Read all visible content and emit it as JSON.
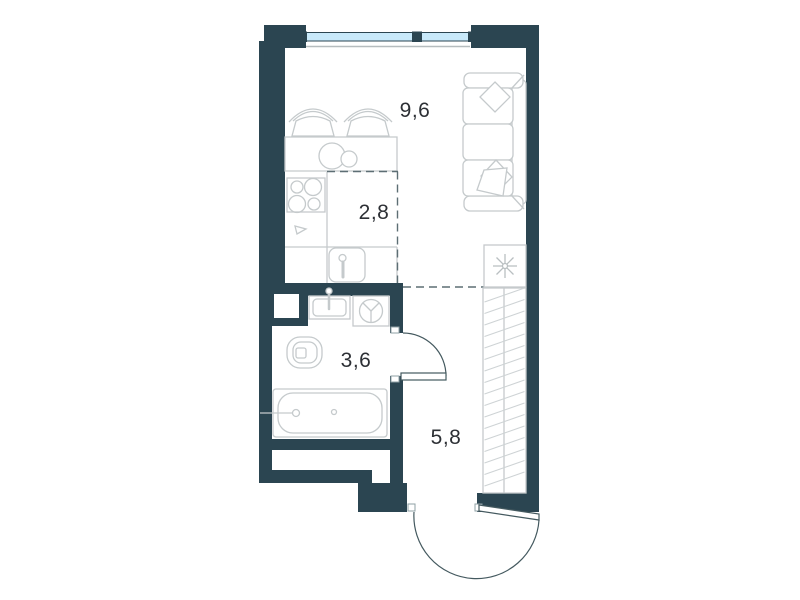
{
  "floor_plan": {
    "type": "studio-apartment-floor-plan",
    "rooms": [
      {
        "name": "living-room",
        "area": "9,6"
      },
      {
        "name": "kitchen-zone",
        "area": "2,8"
      },
      {
        "name": "bathroom",
        "area": "3,6"
      },
      {
        "name": "hallway",
        "area": "5,8"
      }
    ],
    "colors": {
      "wall": "#2b4551",
      "window_glass": "#c8e9fa",
      "furniture_line": "#c5cacc",
      "zone_dashed_line": "#5d6e74",
      "door_line": "#44595f",
      "label_text": "#2d3035",
      "background": "#ffffff"
    },
    "elements": [
      "window",
      "sofa",
      "cushions",
      "pillows",
      "dining-table",
      "chairs",
      "cooktop",
      "kitchen-counter",
      "kitchen-sink",
      "refrigerator-snowflake",
      "wardrobe",
      "bathroom-sink",
      "washing-machine",
      "toilet",
      "bathtub",
      "bathroom-door",
      "entrance-door",
      "ventilation-shaft"
    ]
  }
}
